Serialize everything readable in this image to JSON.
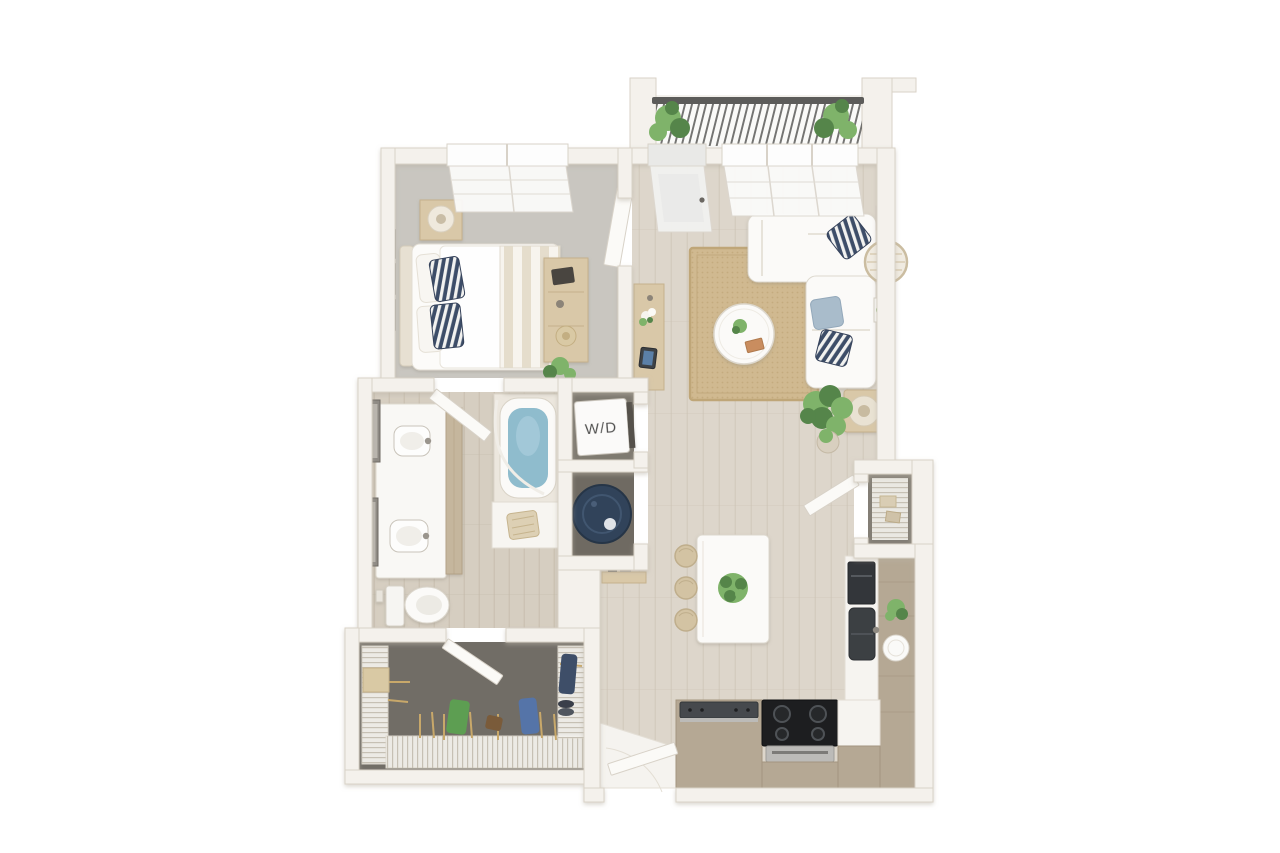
{
  "floorplan": {
    "labels": {
      "washer_dryer": "W/D"
    },
    "colors": {
      "background": "#ffffff",
      "wall": "#f4f1ec",
      "wall_edge": "#d9d2c7",
      "door_panel": "#fbfaf7",
      "door_edge": "#d8d2c8",
      "glass": "#e9e9e7",
      "wood_floor": "#ddd6cb",
      "wood_plank_line": "#cfc6b8",
      "bath_floor": "#d6cec1",
      "bath_plank_line": "#c6bcac",
      "bedroom_carpet": "#c9c6c0",
      "closet_carpet": "#716d66",
      "rug": "#d0b990",
      "rug_dot": "#c2a87c",
      "rug_edge": "#bfa678",
      "white_furniture": "#fbfaf8",
      "white_furniture_edge": "#ddd8ce",
      "wood_furniture": "#d9c8a8",
      "wood_furniture_edge": "#c5b18c",
      "cabinet": "#b5a894",
      "cabinet_edge": "#a3957f",
      "counter": "#f6f4f0",
      "counter_edge": "#e2ddd3",
      "appliance_dark": "#3c4043",
      "range_black": "#1d1e20",
      "stainless": "#bcbbb8",
      "navy": "#3e4e68",
      "pillow_stripe_light": "#f2f2f0",
      "light_blue_pillow": "#a9bccb",
      "water": "#8fbccd",
      "water_heater": "#31435a",
      "plant_green": "#7fb36a",
      "plant_green_dark": "#55854a",
      "railing": "#5c5c5a",
      "frame_dark": "#5f5b55",
      "closet_dark": "#7d786f",
      "label_text": "#4a4a48",
      "blanket_stripe": "#e5ddcc",
      "wire_line": "#c6c0b4",
      "shelf_base": "#f3f1ec"
    }
  }
}
